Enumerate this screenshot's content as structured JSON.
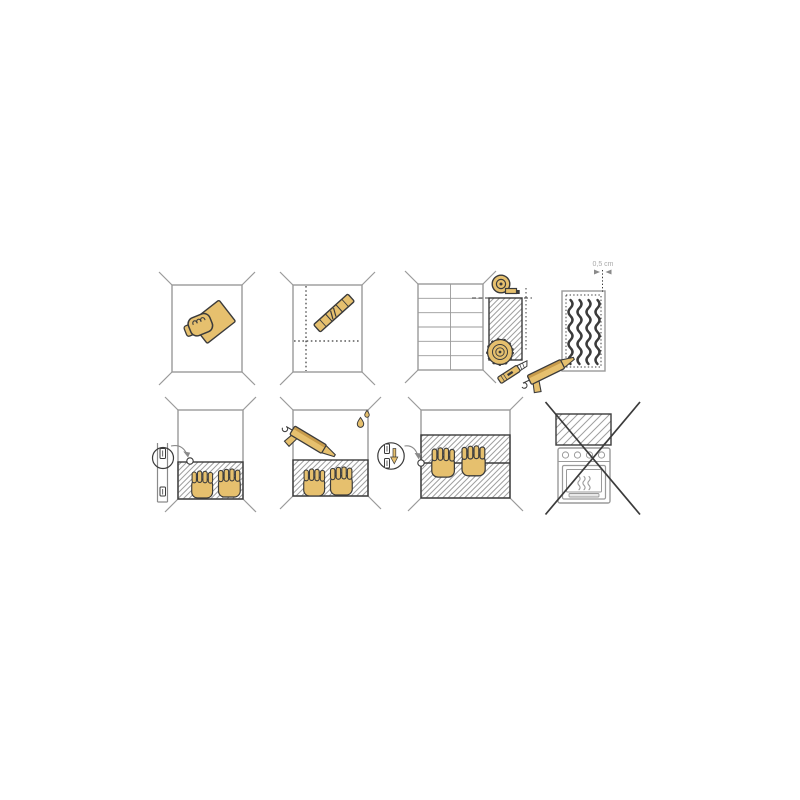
{
  "sheet": {
    "measurement_label": "0,5 cm",
    "steps": [
      {
        "id": 1,
        "name": "clean-wall",
        "icons": [
          "wall",
          "hand-with-sponge-icon"
        ]
      },
      {
        "id": 2,
        "name": "mark-guidelines",
        "icons": [
          "wall",
          "dotted-guideline-vertical",
          "dotted-guideline-horizontal",
          "spirit-level-icon"
        ]
      },
      {
        "id": 3,
        "name": "measure-and-cut-panel",
        "icons": [
          "tiled-wall",
          "measuring-tape-icon",
          "cut-panel",
          "circular-saw-blade-icon",
          "utility-knife-icon"
        ]
      },
      {
        "id": 4,
        "name": "apply-adhesive",
        "icons": [
          "panel-back",
          "adhesive-beads",
          "edge-margin-arrows",
          "caulk-gun-icon"
        ],
        "measurement": "0,5 cm"
      },
      {
        "id": 5,
        "name": "mount-first-panel",
        "icons": [
          "wall",
          "mounted-panel",
          "mounting-rail",
          "magnifier-circle",
          "alignment-arrow",
          "pressing-hand-icon",
          "pressing-hand-icon"
        ]
      },
      {
        "id": 6,
        "name": "seal-top-edge",
        "icons": [
          "wall",
          "mounted-panel",
          "caulk-gun-icon",
          "water-drop-icon",
          "water-drop-icon",
          "pressing-hand-icon",
          "pressing-hand-icon"
        ]
      },
      {
        "id": 7,
        "name": "mount-second-panel",
        "icons": [
          "wall",
          "mounted-panels-with-seam",
          "joint-profile-magnifier",
          "joint-arrow-down",
          "alignment-arrow",
          "pressing-hand-icon",
          "pressing-hand-icon"
        ]
      },
      {
        "id": 8,
        "name": "do-not-install-behind-stove",
        "icons": [
          "panel",
          "oven-icon",
          "prohibition-cross-icon"
        ]
      }
    ]
  },
  "colors": {
    "background": "#ffffff",
    "outline_dark": "#3b3b3b",
    "wall_gray": "#9a9a9a",
    "tan": "#e6c06e",
    "tan_dark": "#c79b4b",
    "label_gray": "#a9a9a9",
    "arrow_gray": "#8a8a8a"
  }
}
